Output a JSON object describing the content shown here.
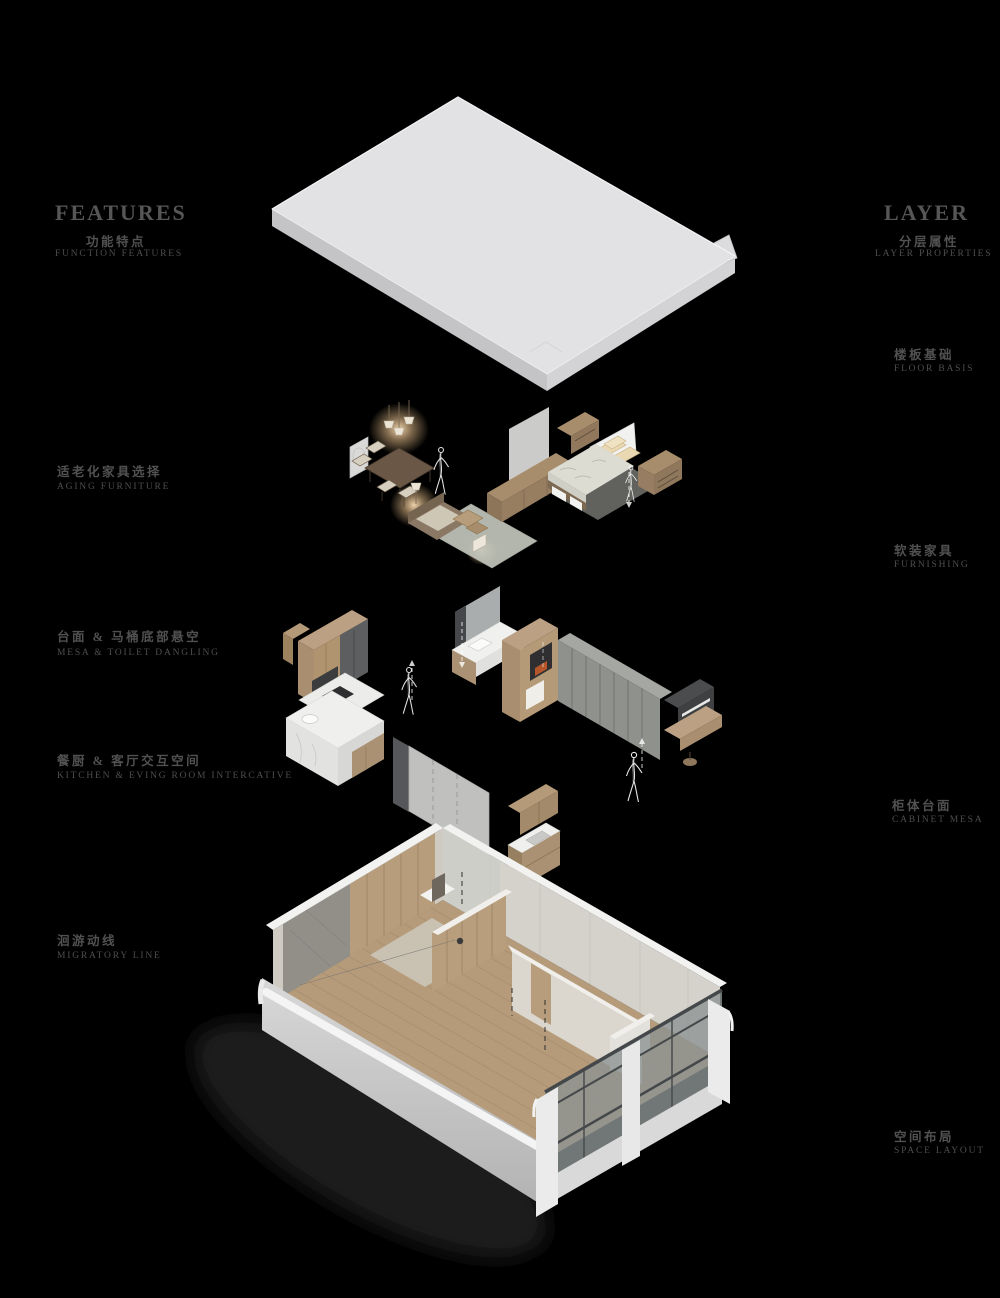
{
  "page": {
    "background": "#000000",
    "title": "exploded interior layer diagram"
  },
  "left_column": {
    "header": {
      "title": "FEATURES",
      "subtitle_zh": "功能特点",
      "subtitle_en": "FUNCTION FEATURES"
    },
    "items": [
      {
        "id": "aging-furniture",
        "zh": "适老化家具选择",
        "en": "AGING FURNITURE"
      },
      {
        "id": "mesa-toilet-dangling",
        "zh": "台面 & 马桶底部悬空",
        "en": "MESA & TOILET DANGLING"
      },
      {
        "id": "kitchen-living-interactive",
        "zh": "餐厨 & 客厅交互空间",
        "en": "KITCHEN & EVING ROOM INTERCATIVE"
      },
      {
        "id": "migratory-line",
        "zh": "洄游动线",
        "en": "MIGRATORY LINE"
      }
    ]
  },
  "right_column": {
    "header": {
      "title": "LAYER",
      "subtitle_zh": "分层属性",
      "subtitle_en": "LAYER PROPERTIES"
    },
    "items": [
      {
        "id": "floor-basis",
        "zh": "楼板基础",
        "en": "FLOOR BASIS"
      },
      {
        "id": "furnishing",
        "zh": "软装家具",
        "en": "FURNISHING"
      },
      {
        "id": "cabinet-mesa",
        "zh": "柜体台面",
        "en": "CABINET MESA"
      },
      {
        "id": "space-layout",
        "zh": "空间布局",
        "en": "SPACE LAYOUT"
      }
    ]
  },
  "diagram": {
    "type": "exploded-axonometric",
    "layers": [
      "floor-slab",
      "furnishing",
      "cabinet-mesa",
      "space-layout-shell"
    ],
    "palette": {
      "background": "#000000",
      "slab_top": "#e2e2e4",
      "slab_side": "#c6c6c8",
      "wood_light": "#b49a78",
      "wood_mid": "#a98f6f",
      "wood_dark": "#6a5745",
      "marble": "#efefed",
      "glass": "#8d9494",
      "window_frame": "#45494b",
      "wall_white": "#f2f2f0",
      "wall_gray": "#d5d2cb",
      "concrete": "#8f8d86",
      "floor_wood": "#b59b7a",
      "rug": "#c4c7bd",
      "bedding": "#dcdcd3",
      "pillow": "#e9d8b1",
      "lamp_glow": "#f3cf9e",
      "wardrobe_gray": "#8f918d",
      "fireplace_accent": "#b4562a",
      "text_gray": "#5a5a5a",
      "sketch_line": "#ffffff"
    }
  }
}
